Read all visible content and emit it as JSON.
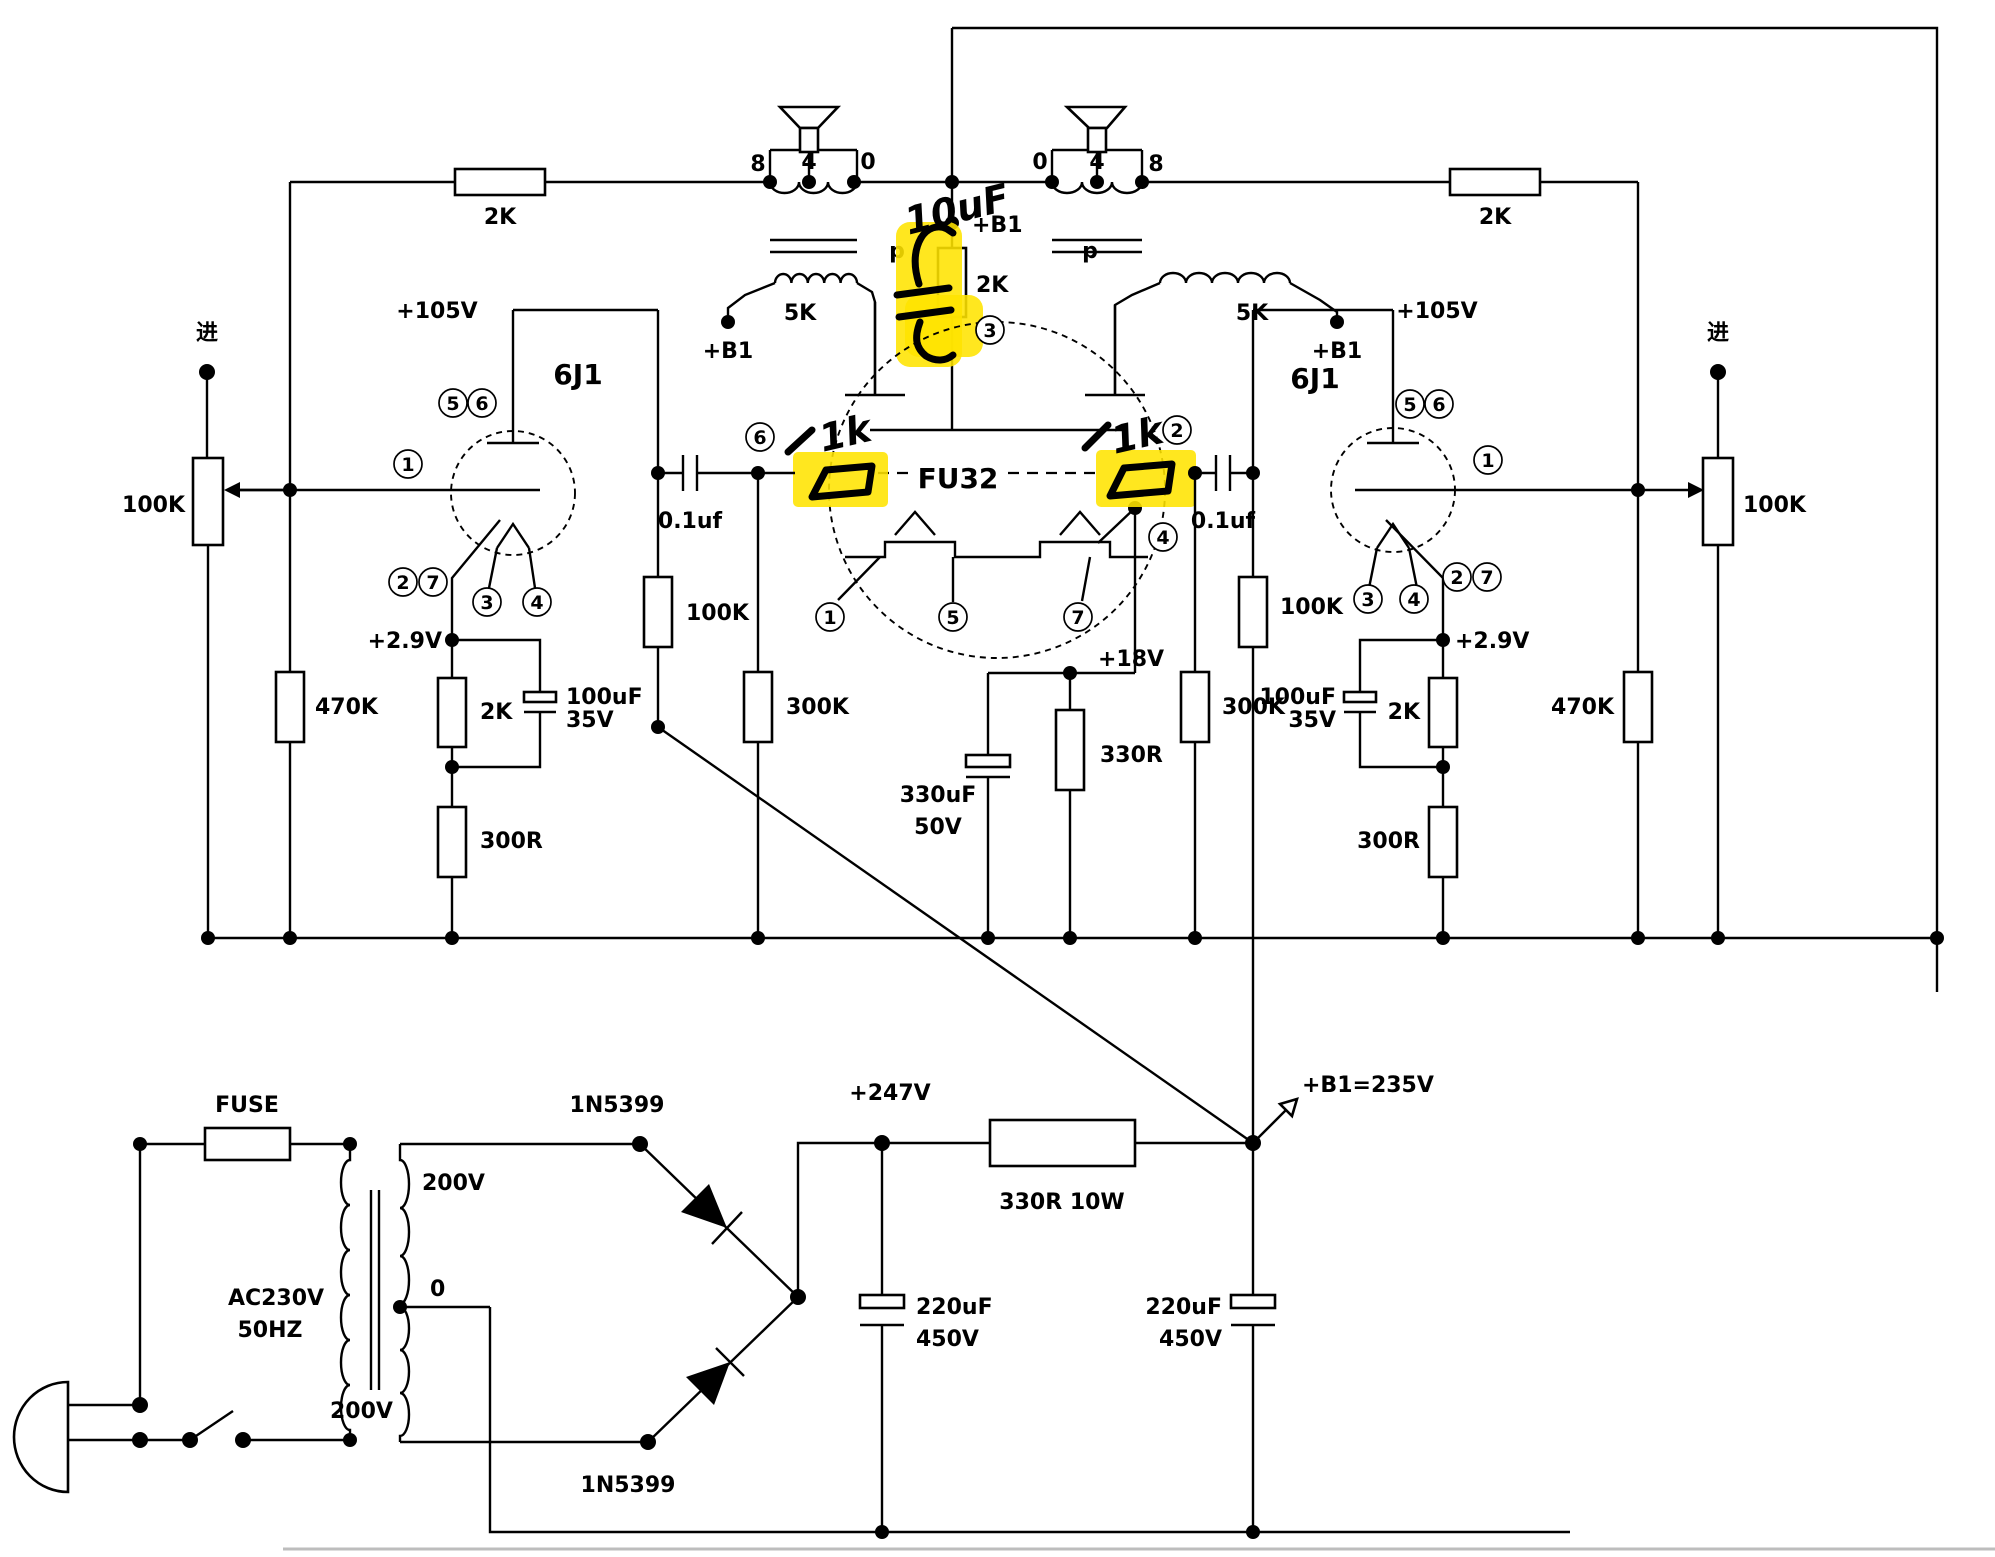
{
  "t": {
    "jin_l": "进",
    "jin_r": "进",
    "pot_l": "100K",
    "pot_r": "100K",
    "r470k_l": "470K",
    "r470k_r": "470K",
    "v105_l": "+105V",
    "v105_r": "+105V",
    "tube6j1_l": "6J1",
    "tube6j1_r": "6J1",
    "p1_l": "1",
    "p5_l": "5",
    "p6_l": "6",
    "p2_l": "2",
    "p7_l": "7",
    "p3_l": "3",
    "p4_l": "4",
    "p1_r": "1",
    "p5_r": "5",
    "p6_r": "6",
    "p2_r": "2",
    "p7_r": "7",
    "p3_r": "3",
    "p4_r": "4",
    "v29_l": "+2.9V",
    "v29_r": "+2.9V",
    "r2k_cath_l": "2K",
    "r2k_cath_r": "2K",
    "c100uf_l": "100uF",
    "c35v_l": "35V",
    "c100uf_r": "100uF",
    "c35v_r": "35V",
    "r300r_l": "300R",
    "r300r_r": "300R",
    "c01_l": "0.1uf",
    "c01_r": "0.1uf",
    "r100k_l": "100K",
    "r100k_r": "100K",
    "r300k_l": "300K",
    "r300k_r": "300K",
    "rfb_l": "2K",
    "rfb_r": "2K",
    "tap8_l": "8",
    "tap4_l": "4",
    "tap0_l": "0",
    "tap0_r": "0",
    "tap4_r": "4",
    "tap8_r": "8",
    "imp5k_l": "5K",
    "imp5k_r": "5K",
    "b1_l": "+B1",
    "b1_r": "+B1",
    "b1_c": "+B1",
    "p_l": "p",
    "p_r": "p",
    "r2k_scr": "2K",
    "fu32": "FU32",
    "fp6": "6",
    "fp2": "2",
    "fp3": "3",
    "fp4": "4",
    "fp1": "1",
    "fp5": "5",
    "fp7": "7",
    "c330uf": "330uF",
    "c50v": "50V",
    "v18": "+18V",
    "r330r": "330R",
    "hw_10uf": "10uF",
    "hw_1k_l": "1k",
    "hw_1k_r": "1k",
    "fuse": "FUSE",
    "ac1": "AC230V",
    "ac2": "50HZ",
    "sec200t": "200V",
    "sec0": "0",
    "sec200b": "200V",
    "d1": "1N5399",
    "d2": "1N5399",
    "v247": "+247V",
    "r330_10w": "330R 10W",
    "b1v": "+B1=235V",
    "cap1a": "220uF",
    "cap1b": "450V",
    "cap2a": "220uF",
    "cap2b": "450V"
  }
}
